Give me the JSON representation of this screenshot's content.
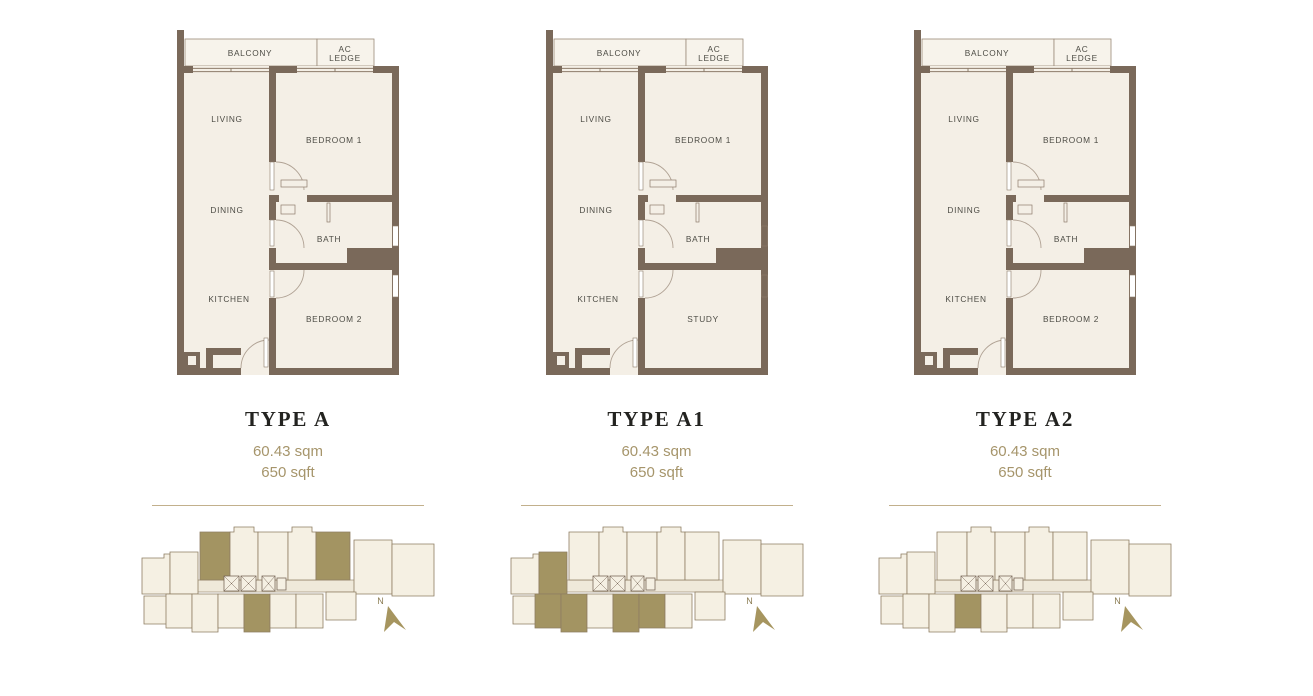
{
  "colors": {
    "wall": "#7a695a",
    "room_fill": "#f4efe6",
    "balcony_fill": "#f7f3eb",
    "accent_text": "#a6956b",
    "title_text": "#232320",
    "room_label": "#4d4c45",
    "keyplan_highlight": "#a39462",
    "divider_line": "#c2b08c",
    "north_arrow": "#a6955f"
  },
  "plans": [
    {
      "title": "TYPE A",
      "area_sqm": "60.43 sqm",
      "area_sqft": "650 sqft",
      "rooms": {
        "balcony": "BALCONY",
        "ac_line1": "AC",
        "ac_line2": "LEDGE",
        "living": "LIVING",
        "dining": "DINING",
        "kitchen": "KITCHEN",
        "bedroom1": "BEDROOM 1",
        "bath": "BATH",
        "room2": "BEDROOM 2"
      },
      "right_windows": true,
      "keyplan": {
        "north_label": "N",
        "highlights": [
          "t1",
          "t5",
          "b4"
        ]
      }
    },
    {
      "title": "TYPE A1",
      "area_sqm": "60.43 sqm",
      "area_sqft": "650 sqft",
      "rooms": {
        "balcony": "BALCONY",
        "ac_line1": "AC",
        "ac_line2": "LEDGE",
        "living": "LIVING",
        "dining": "DINING",
        "kitchen": "KITCHEN",
        "bedroom1": "BEDROOM 1",
        "bath": "BATH",
        "room2": "STUDY"
      },
      "right_windows": false,
      "keyplan": {
        "north_label": "N",
        "highlights": [
          "l2",
          "b1",
          "b2",
          "b4",
          "b5"
        ]
      }
    },
    {
      "title": "TYPE A2",
      "area_sqm": "60.43 sqm",
      "area_sqft": "650 sqft",
      "rooms": {
        "balcony": "BALCONY",
        "ac_line1": "AC",
        "ac_line2": "LEDGE",
        "living": "LIVING",
        "dining": "DINING",
        "kitchen": "KITCHEN",
        "bedroom1": "BEDROOM 1",
        "bath": "BATH",
        "room2": "BEDROOM 2"
      },
      "right_windows": true,
      "keyplan": {
        "north_label": "N",
        "highlights": [
          "b3"
        ]
      }
    }
  ]
}
